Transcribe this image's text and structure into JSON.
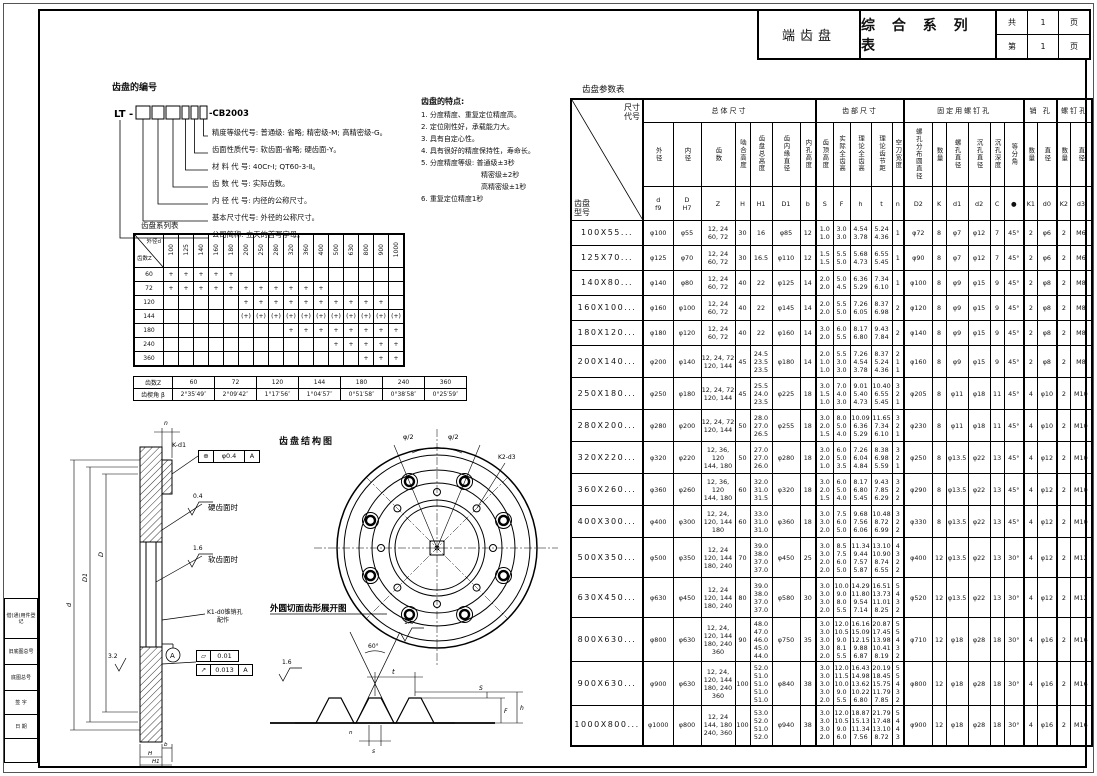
{
  "title_block": {
    "product": "端齿盘",
    "doc": "综 合 系 列 表",
    "row1": [
      "共",
      "1",
      "页"
    ],
    "row2": [
      "第",
      "1",
      "页"
    ]
  },
  "numbering": {
    "heading": "齿盘的编号",
    "prefix": "LT -",
    "suffix": "-CB2003",
    "legend": [
      "精度等级代号: 普通级: 省略; 精密级-M; 高精密级-G。",
      "齿面性质代号: 软齿面-省略; 硬齿面-Y。",
      "材 料 代 号: 40Cr-Ⅰ; QT60-3-Ⅱ。",
      "齿 数 代 号: 实际齿数。",
      "内 径 代 号: 内径的公称尺寸。",
      "基本尺寸代号: 外径的公称尺寸。",
      "公司简称: 立天的首写字母。"
    ]
  },
  "features": {
    "heading": "齿盘的特点:",
    "lines": [
      "1. 分度精度、重复定位精度高。",
      "2. 定位刚性好，承载能力大。",
      "3. 具有自定心性。",
      "4. 具有很好的精度保持性，寿命长。",
      "5. 分度精度等级: 普通级±3秒",
      "精密级±2秒",
      "高精密级±1秒",
      "6. 重复定位精度1秒"
    ]
  },
  "series_table": {
    "title": "齿盘系列表",
    "corner_top": "外径d",
    "corner_bottom": "齿数Z",
    "columns": [
      "100",
      "125",
      "140",
      "160",
      "180",
      "200",
      "250",
      "280",
      "320",
      "360",
      "400",
      "500",
      "630",
      "800",
      "900",
      "1000"
    ],
    "rows": [
      {
        "z": "60",
        "marks": [
          "+",
          "+",
          "+",
          "+",
          "+",
          "",
          "",
          "",
          "",
          "",
          "",
          "",
          "",
          "",
          "",
          ""
        ]
      },
      {
        "z": "72",
        "marks": [
          "+",
          "+",
          "+",
          "+",
          "+",
          "+",
          "+",
          "+",
          "+",
          "+",
          "+",
          "",
          "",
          "",
          "",
          ""
        ]
      },
      {
        "z": "120",
        "marks": [
          "",
          "",
          "",
          "",
          "",
          "+",
          "+",
          "+",
          "+",
          "+",
          "+",
          "+",
          "+",
          "+",
          "+",
          ""
        ]
      },
      {
        "z": "144",
        "marks": [
          "",
          "",
          "",
          "",
          "",
          "(+)",
          "(+)",
          "(+)",
          "(+)",
          "(+)",
          "(+)",
          "(+)",
          "(+)",
          "(+)",
          "(+)",
          "(+)"
        ]
      },
      {
        "z": "180",
        "marks": [
          "",
          "",
          "",
          "",
          "",
          "",
          "",
          "",
          "+",
          "+",
          "+",
          "+",
          "+",
          "+",
          "+",
          "+"
        ]
      },
      {
        "z": "240",
        "marks": [
          "",
          "",
          "",
          "",
          "",
          "",
          "",
          "",
          "",
          "",
          "",
          "+",
          "+",
          "+",
          "+",
          "+"
        ]
      },
      {
        "z": "360",
        "marks": [
          "",
          "",
          "",
          "",
          "",
          "",
          "",
          "",
          "",
          "",
          "",
          "",
          "",
          "+",
          "+",
          "+"
        ]
      }
    ]
  },
  "angle_table": {
    "header": "齿数Z",
    "row_label": "齿楔角 β",
    "columns": [
      "60",
      "72",
      "120",
      "144",
      "180",
      "240",
      "360"
    ],
    "values": [
      "2°35′49″",
      "2°09′42″",
      "1°17′56″",
      "1°04′57″",
      "0°51′58″",
      "0°38′58″",
      "0°25′59″"
    ]
  },
  "param_table": {
    "title": "齿盘参数表",
    "corner_top": "尺寸\n代号",
    "corner_bottom": "齿盘\n型号",
    "groups": [
      {
        "label": "总体尺寸",
        "span": 7
      },
      {
        "label": "齿部尺寸",
        "span": 5
      },
      {
        "label": "固定用螺钉孔",
        "span": 6
      },
      {
        "label": "销 孔",
        "span": 2
      },
      {
        "label": "螺钉孔",
        "span": 2
      }
    ],
    "col_names": [
      "外径",
      "内径",
      "齿数",
      "啮合高度",
      "齿盘总高度",
      "齿内缘直径",
      "内孔高度",
      "齿顶高度",
      "实际全齿高",
      "理论全齿高",
      "理论齿节距",
      "空刀宽度",
      "螺孔分布圆直径",
      "数量",
      "螺孔直径",
      "沉孔直径",
      "沉孔深度",
      "等分角",
      "数量",
      "直径",
      "数量",
      "直径"
    ],
    "col_syms": [
      "d\nf9",
      "D\nH7",
      "Z",
      "H",
      "H1",
      "D1",
      "b",
      "S",
      "F",
      "h",
      "t",
      "n",
      "D2",
      "K",
      "d1",
      "d2",
      "C",
      "●",
      "K1",
      "d0",
      "K2",
      "d3"
    ],
    "rows": [
      [
        "100X55...",
        "φ100",
        "φ55",
        "12, 24\n60, 72",
        "30",
        "16",
        "φ85",
        "12",
        "1.0\n1.0",
        "3.0\n3.0",
        "4.54\n3.78",
        "5.24\n4.36",
        "1",
        "φ72",
        "8",
        "φ7",
        "φ12",
        "7",
        "45°",
        "2",
        "φ6",
        "2",
        "M6"
      ],
      [
        "125X70...",
        "φ125",
        "φ70",
        "12, 24\n60, 72",
        "30",
        "16.5",
        "φ110",
        "12",
        "1.5\n1.5",
        "5.5\n5.0",
        "5.68\n4.73",
        "6.55\n5.45",
        "1",
        "φ90",
        "8",
        "φ7",
        "φ12",
        "7",
        "45°",
        "2",
        "φ6",
        "2",
        "M6"
      ],
      [
        "140X80...",
        "φ140",
        "φ80",
        "12, 24\n60, 72",
        "40",
        "22",
        "φ125",
        "14",
        "2.0\n2.0",
        "5.0\n4.5",
        "6.36\n5.29",
        "7.34\n6.10",
        "1",
        "φ100",
        "8",
        "φ9",
        "φ15",
        "9",
        "45°",
        "2",
        "φ8",
        "2",
        "M8"
      ],
      [
        "160X100...",
        "φ160",
        "φ100",
        "12, 24\n60, 72",
        "40",
        "22",
        "φ145",
        "14",
        "2.0\n2.0",
        "5.5\n5.0",
        "7.26\n6.05",
        "8.37\n6.98",
        "2",
        "φ120",
        "8",
        "φ9",
        "φ15",
        "9",
        "45°",
        "2",
        "φ8",
        "2",
        "M8"
      ],
      [
        "180X120...",
        "φ180",
        "φ120",
        "12, 24\n60, 72",
        "40",
        "22",
        "φ160",
        "14",
        "3.0\n2.0",
        "6.0\n5.5",
        "8.17\n6.80",
        "9.43\n7.84",
        "2",
        "φ140",
        "8",
        "φ9",
        "φ15",
        "9",
        "45°",
        "2",
        "φ8",
        "2",
        "M8"
      ],
      [
        "200X140...",
        "φ200",
        "φ140",
        "12, 24, 72\n120, 144",
        "45",
        "24.5\n23.5\n23.5",
        "φ180",
        "14",
        "2.0\n1.0\n1.0",
        "5.5\n3.0\n3.0",
        "7.26\n4.54\n3.78",
        "8.37\n5.24\n4.36",
        "2\n1\n1",
        "φ160",
        "8",
        "φ9",
        "φ15",
        "9",
        "45°",
        "2",
        "φ8",
        "2",
        "M8"
      ],
      [
        "250X180...",
        "φ250",
        "φ180",
        "12, 24, 72\n120, 144",
        "45",
        "25.5\n24.0\n23.5",
        "φ225",
        "18",
        "3.0\n1.5\n1.0",
        "7.0\n4.0\n3.0",
        "9.01\n5.40\n4.73",
        "10.40\n6.55\n5.45",
        "3\n2\n1",
        "φ205",
        "8",
        "φ11",
        "φ18",
        "11",
        "45°",
        "4",
        "φ10",
        "2",
        "M10"
      ],
      [
        "280X200...",
        "φ280",
        "φ200",
        "12, 24, 72\n120, 144",
        "50",
        "28.0\n27.0\n26.5",
        "φ255",
        "18",
        "3.0\n2.0\n1.5",
        "8.0\n5.0\n4.0",
        "10.09\n6.36\n5.29",
        "11.65\n7.34\n6.10",
        "3\n2\n1",
        "φ230",
        "8",
        "φ11",
        "φ18",
        "11",
        "45°",
        "4",
        "φ10",
        "2",
        "M10"
      ],
      [
        "320X220...",
        "φ320",
        "φ220",
        "12, 36, 120\n144, 180",
        "50",
        "27.0\n27.0\n26.0",
        "φ280",
        "18",
        "3.0\n2.0\n1.0",
        "6.0\n5.0\n3.5",
        "7.26\n6.04\n4.84",
        "8.38\n6.98\n5.59",
        "3\n2\n1",
        "φ250",
        "8",
        "φ13.5",
        "φ22",
        "13",
        "45°",
        "4",
        "φ12",
        "2",
        "M10"
      ],
      [
        "360X260...",
        "φ360",
        "φ260",
        "12, 36, 120\n144, 180",
        "60",
        "32.0\n31.0\n31.5",
        "φ320",
        "18",
        "3.0\n2.0\n1.5",
        "6.0\n5.0\n4.0",
        "8.17\n6.80\n5.45",
        "9.43\n7.85\n6.29",
        "3\n2\n2",
        "φ290",
        "8",
        "φ13.5",
        "φ22",
        "13",
        "45°",
        "4",
        "φ12",
        "2",
        "M10"
      ],
      [
        "400X300...",
        "φ400",
        "φ300",
        "12, 24,\n120, 144\n180",
        "60",
        "33.0\n31.0\n31.0",
        "φ360",
        "18",
        "3.0\n3.0\n2.0",
        "7.5\n6.0\n5.0",
        "9.68\n7.56\n6.06",
        "10.48\n8.72\n6.99",
        "3\n2\n2",
        "φ330",
        "8",
        "φ13.5",
        "φ22",
        "13",
        "45°",
        "4",
        "φ12",
        "2",
        "M10"
      ],
      [
        "500X350...",
        "φ500",
        "φ350",
        "12, 24\n120, 144\n180, 240",
        "70",
        "39.0\n38.0\n37.0\n37.0",
        "φ450",
        "25",
        "3.0\n3.0\n2.0\n2.0",
        "8.5\n7.5\n6.0\n5.0",
        "11.34\n9.44\n7.57\n5.87",
        "13.10\n10.90\n8.74\n6.55",
        "4\n3\n2\n2",
        "φ400",
        "12",
        "φ13.5",
        "φ22",
        "13",
        "30°",
        "4",
        "φ12",
        "2",
        "M12"
      ],
      [
        "630X450...",
        "φ630",
        "φ450",
        "12, 24\n120, 144\n180, 240",
        "80",
        "39.0\n38.0\n37.0\n37.0",
        "φ580",
        "30",
        "3.0\n3.0\n3.0\n2.0",
        "10.0\n9.0\n8.0\n5.5",
        "14.29\n11.80\n9.54\n7.14",
        "16.51\n13.73\n11.01\n8.25",
        "5\n4\n3\n2",
        "φ520",
        "12",
        "φ13.5",
        "φ22",
        "13",
        "30°",
        "4",
        "φ12",
        "2",
        "M12"
      ],
      [
        "800X630...",
        "φ800",
        "φ630",
        "12, 24,\n120, 144\n180, 240\n360",
        "90",
        "48.0\n47.0\n46.0\n45.0\n44.0",
        "φ750",
        "35",
        "3.0\n3.0\n3.0\n3.0\n2.0",
        "12.0\n10.5\n9.0\n8.1\n5.5",
        "16.16\n15.09\n12.15\n9.88\n6.87",
        "20.87\n17.45\n13.98\n10.41\n8.19",
        "5\n5\n4\n3\n2",
        "φ710",
        "12",
        "φ18",
        "φ28",
        "18",
        "30°",
        "4",
        "φ16",
        "2",
        "M16"
      ],
      [
        "900X630...",
        "φ900",
        "φ630",
        "12, 24,\n120, 144\n180, 240\n360",
        "100",
        "52.0\n51.0\n51.0\n51.0\n51.0",
        "φ840",
        "38",
        "3.0\n3.0\n3.0\n3.0\n2.0",
        "12.0\n11.5\n10.0\n9.0\n5.5",
        "16.43\n14.98\n13.62\n10.22\n6.80",
        "20.19\n18.45\n15.75\n11.79\n7.85",
        "5\n5\n4\n3\n2",
        "φ800",
        "12",
        "φ18",
        "φ28",
        "18",
        "30°",
        "4",
        "φ16",
        "2",
        "M16"
      ],
      [
        "1000X800...",
        "φ1000",
        "φ800",
        "12, 24\n144, 180\n240, 360",
        "100",
        "53.0\n52.0\n51.0\n52.0",
        "φ940",
        "38",
        "3.0\n3.0\n3.0\n2.0",
        "12.0\n10.5\n9.0\n6.0",
        "18.87\n15.13\n11.34\n7.56",
        "21.79\n17.48\n13.10\n8.72",
        "5\n4\n4\n3",
        "φ900",
        "12",
        "φ18",
        "φ28",
        "18",
        "30°",
        "4",
        "φ16",
        "2",
        "M16"
      ]
    ]
  },
  "drawings": {
    "structure_title": "齿盘结构图",
    "develop_title": "外圆切面齿形展开图",
    "hard_face": "硬齿面时",
    "soft_face": "软齿面时",
    "r_hard": "0.4",
    "r_soft": "1.6",
    "r_side": "3.2",
    "r_tooth": "1.6",
    "r_tooth2": "1.6",
    "frame1": {
      "label": "K-d1",
      "sym": "⊕",
      "tol": "φ0.4",
      "datum": "A"
    },
    "flat": {
      "sym": "▱",
      "tol": "0.01"
    },
    "runout": {
      "sym": "↗",
      "tol": "0.013",
      "datum": "A"
    },
    "datum": "A",
    "pin1": "K1-d0锥销孔",
    "pin2": "配作",
    "half_l": "φ/2",
    "half_r": "φ/2",
    "hole_note": "K2-d3",
    "angle60": "60°",
    "dims": {
      "t": "t",
      "s": "S",
      "h": "h",
      "f": "F",
      "sb": "s",
      "n": "n",
      "b": "b",
      "H": "H",
      "H1": "H1",
      "d": "d",
      "D": "D",
      "D1": "D1",
      "D2": "D2"
    }
  },
  "strip_rows": [
    "借(通)用件登记",
    "旧底图总号",
    "底图总号",
    "签 字",
    "日 期"
  ]
}
